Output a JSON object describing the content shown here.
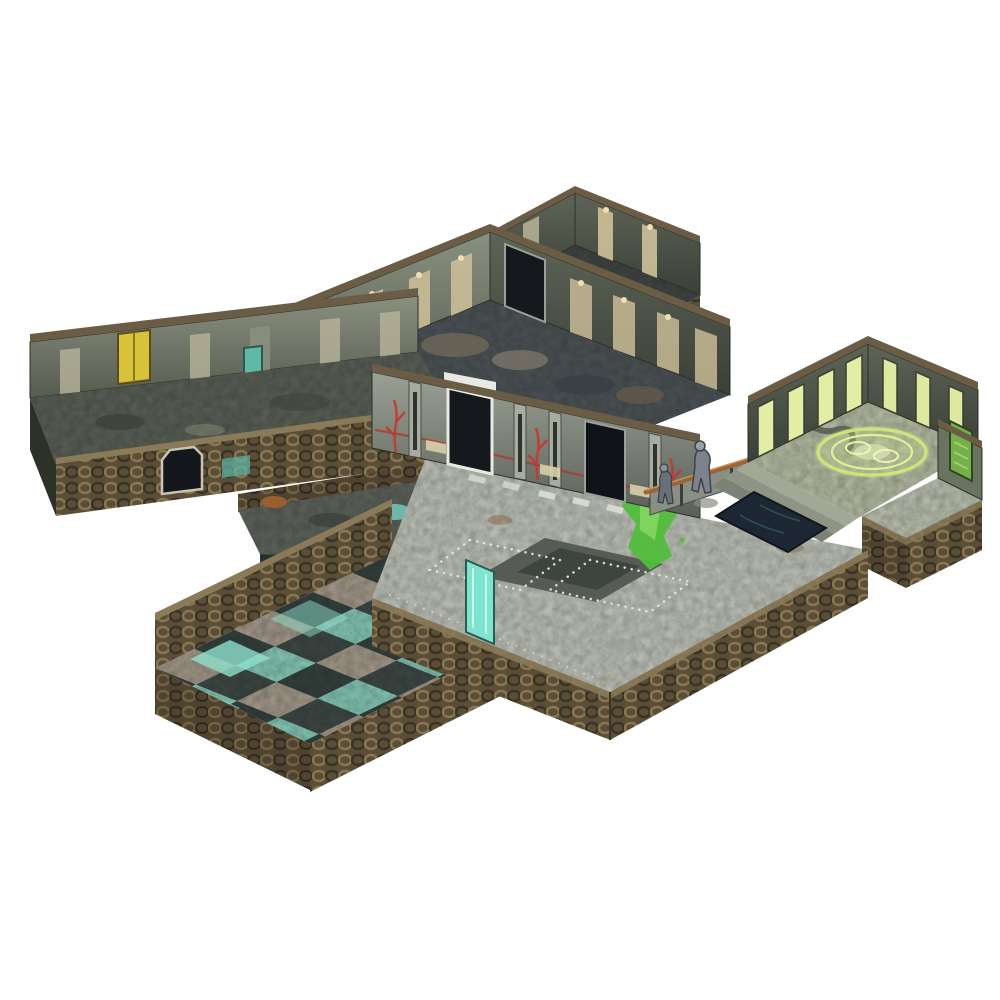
{
  "image": {
    "alt": "Isometric product photo of a modular sci-fi dungeon tabletop terrain set arranged on a white background",
    "background": "#ffffff"
  },
  "palette": {
    "bg": "#ffffff",
    "wall-ext": "#5a4e39",
    "wall-ext-ring": "#8a7750",
    "wall-ext-shadow": "#3a3222",
    "wall-int": "#7b8274",
    "wall-int-dark": "#4e5548",
    "panel-glow": "#cfc19a",
    "panel-green": "#e4eda6",
    "floor-dark": "#4a4f4c",
    "floor-grimy": "#565b52",
    "floor-hall": "#b6bab0",
    "floor-sage": "#aeb49c",
    "plate-dark": "#565c55",
    "plate-inner": "#3e443e",
    "orange-ring": "#c4823a",
    "orange-core": "#8a5a26",
    "slime": "#52bd3c",
    "slime-light": "#7ed45e",
    "glyph-green": "#cfe87a",
    "glyph-glow": "#eef7c4",
    "teal": "#7fd8c4",
    "teal-deep": "#4aa898",
    "tile-dark": "#323c3a",
    "tile-teal": "#7fbfae",
    "pit": "#1d2733",
    "red-glyph": "#c2392e",
    "yellow-door": "#d8c23a",
    "white-frame": "#e8e9e2",
    "door-void": "#14181c",
    "copper": "#9a6536",
    "copper-light": "#c89058",
    "banner-green": "#76b048",
    "statue-grey": "#7d838c",
    "step1": "#a2a896",
    "step2": "#8f9584",
    "step3": "#7d8374",
    "slab-side": "#2a2f2a"
  },
  "modules": [
    {
      "name": "top-room",
      "label": "Small storage room (upper)"
    },
    {
      "name": "machine-room",
      "label": "Machine room with rusted circular emblem"
    },
    {
      "name": "left-corridor",
      "label": "Left corridor with yellow door and archway"
    },
    {
      "name": "connector-corridor",
      "label": "Connector corridor with rust debris and teal puddle"
    },
    {
      "name": "cistern-room",
      "label": "Cistern room with teal checkerboard floor"
    },
    {
      "name": "central-hall",
      "label": "Central hall with slime stain and floor plate"
    },
    {
      "name": "gate-wall",
      "label": "Gate wall with doors and red glyph conduits"
    },
    {
      "name": "ritual-room",
      "label": "Ritual room with glowing green circle, steps and pit"
    },
    {
      "name": "alcove",
      "label": "Side alcove with green banner"
    }
  ]
}
